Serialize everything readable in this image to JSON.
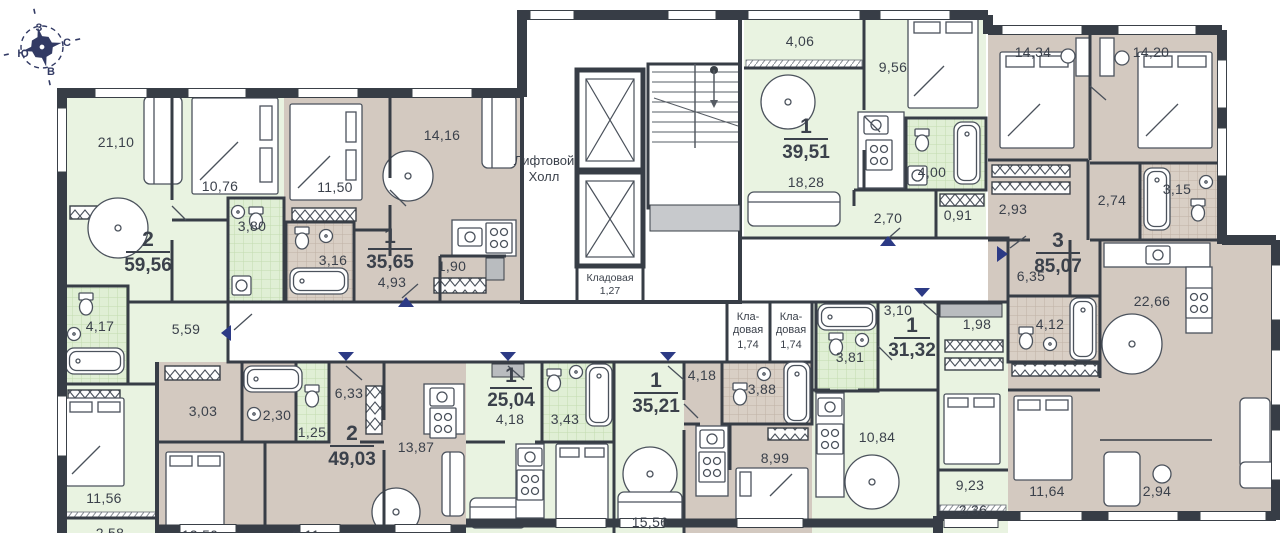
{
  "palette": {
    "green_room": "#e9f3e1",
    "green_tile": "#e0efd5",
    "tan_room": "#d3c9c0",
    "tan_tile": "#d9cfc5",
    "corridor": "#f1f1f2",
    "wall": "#373d46",
    "accent_blue": "#2c3a85",
    "text": "#3b414b"
  },
  "compass": {
    "up": "З",
    "right": "С",
    "left": "Ю",
    "down": "В"
  },
  "common": {
    "elevator_hall_line1": "Лифтовой",
    "elevator_hall_line2": "Холл",
    "storage_hall": {
      "name": "Кладовая",
      "area": "1,27"
    },
    "storage_left": {
      "name_line1": "Кла-",
      "name_line2": "довая",
      "area": "1,74"
    },
    "storage_right": {
      "name_line1": "Кла-",
      "name_line2": "довая",
      "area": "1,74"
    }
  },
  "apartments": [
    {
      "number": "2",
      "total_area": "59,56",
      "room_areas": [
        "21,10",
        "10,76",
        "3,80",
        "4,17",
        "5,59",
        "11,56",
        "2,58"
      ]
    },
    {
      "number": "1",
      "total_area": "35,65",
      "room_areas": [
        "11,50",
        "14,16",
        "3,16",
        "4,93",
        "1,90"
      ]
    },
    {
      "number": "1",
      "total_area": "39,51",
      "room_areas": [
        "4,06",
        "9,56",
        "18,28",
        "4,00",
        "2,70",
        "0,91"
      ]
    },
    {
      "number": "3",
      "total_area": "85,07",
      "room_areas": [
        "14,34",
        "14,20",
        "2,93",
        "2,74",
        "3,15",
        "6,35",
        "4,12",
        "22,66",
        "11,64",
        "2,94"
      ]
    },
    {
      "number": "2",
      "total_area": "49,03",
      "room_areas": [
        "3,03",
        "2,30",
        "1,25",
        "6,33",
        "13,87",
        "12,50",
        "9,11"
      ]
    },
    {
      "number": "1",
      "total_area": "25,04",
      "room_areas": [
        "4,18",
        "3,43"
      ]
    },
    {
      "number": "1",
      "total_area": "35,21",
      "room_areas": [
        "15,56",
        "4,18",
        "3,88",
        "8,99"
      ]
    },
    {
      "number": "1",
      "total_area": "31,32",
      "room_areas": [
        "3,10",
        "1,98",
        "3,81",
        "10,84",
        "9,23",
        "2,36"
      ]
    }
  ]
}
